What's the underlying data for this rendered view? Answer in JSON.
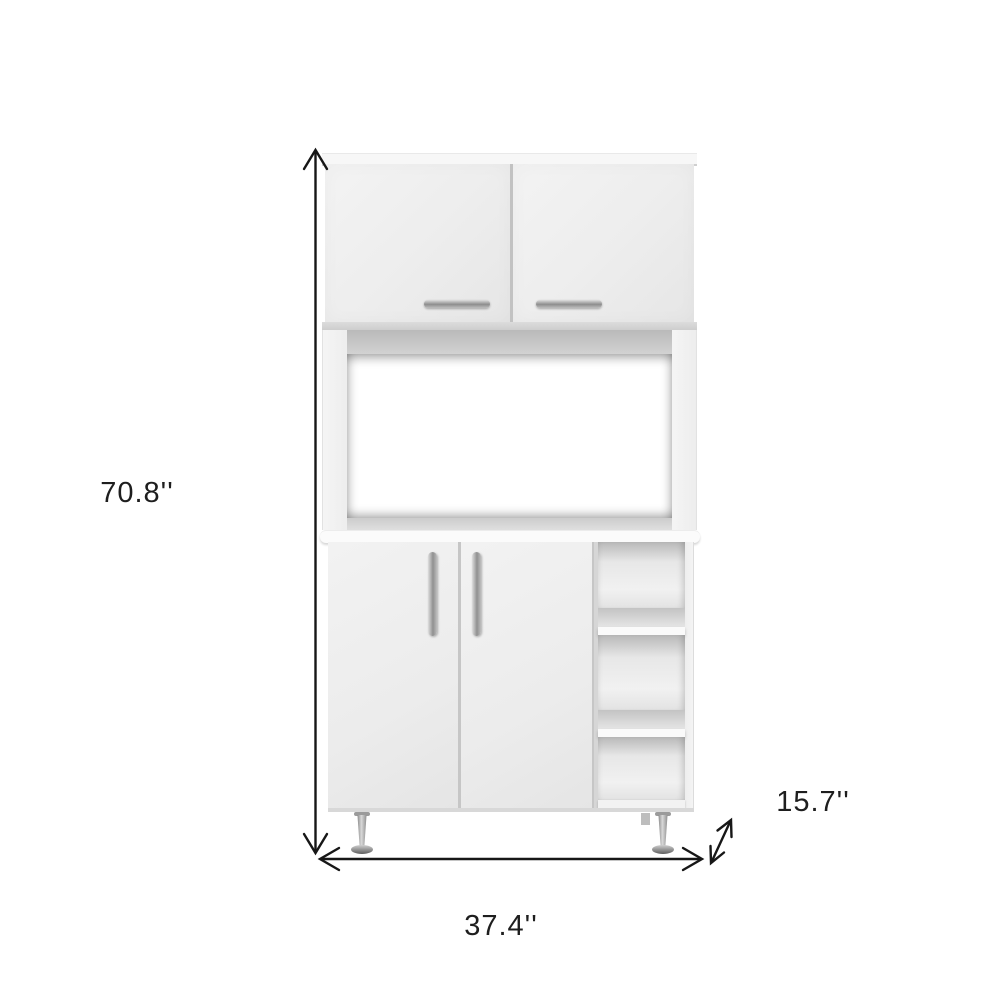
{
  "figure": {
    "background_color": "#ffffff",
    "annotation_color": "#1c1c1c"
  },
  "dimensions": {
    "height_label": "70.8''",
    "width_label": "37.4''",
    "depth_label": "15.7''"
  },
  "cabinet": {
    "body_color": "#ededed",
    "shade_color": "#c6c6c6",
    "handle_color": "#a0a0a0",
    "leg_color": "#8e8e8e",
    "upper_door_count": 2,
    "lower_door_count": 2,
    "open_shelf_count": 3
  }
}
